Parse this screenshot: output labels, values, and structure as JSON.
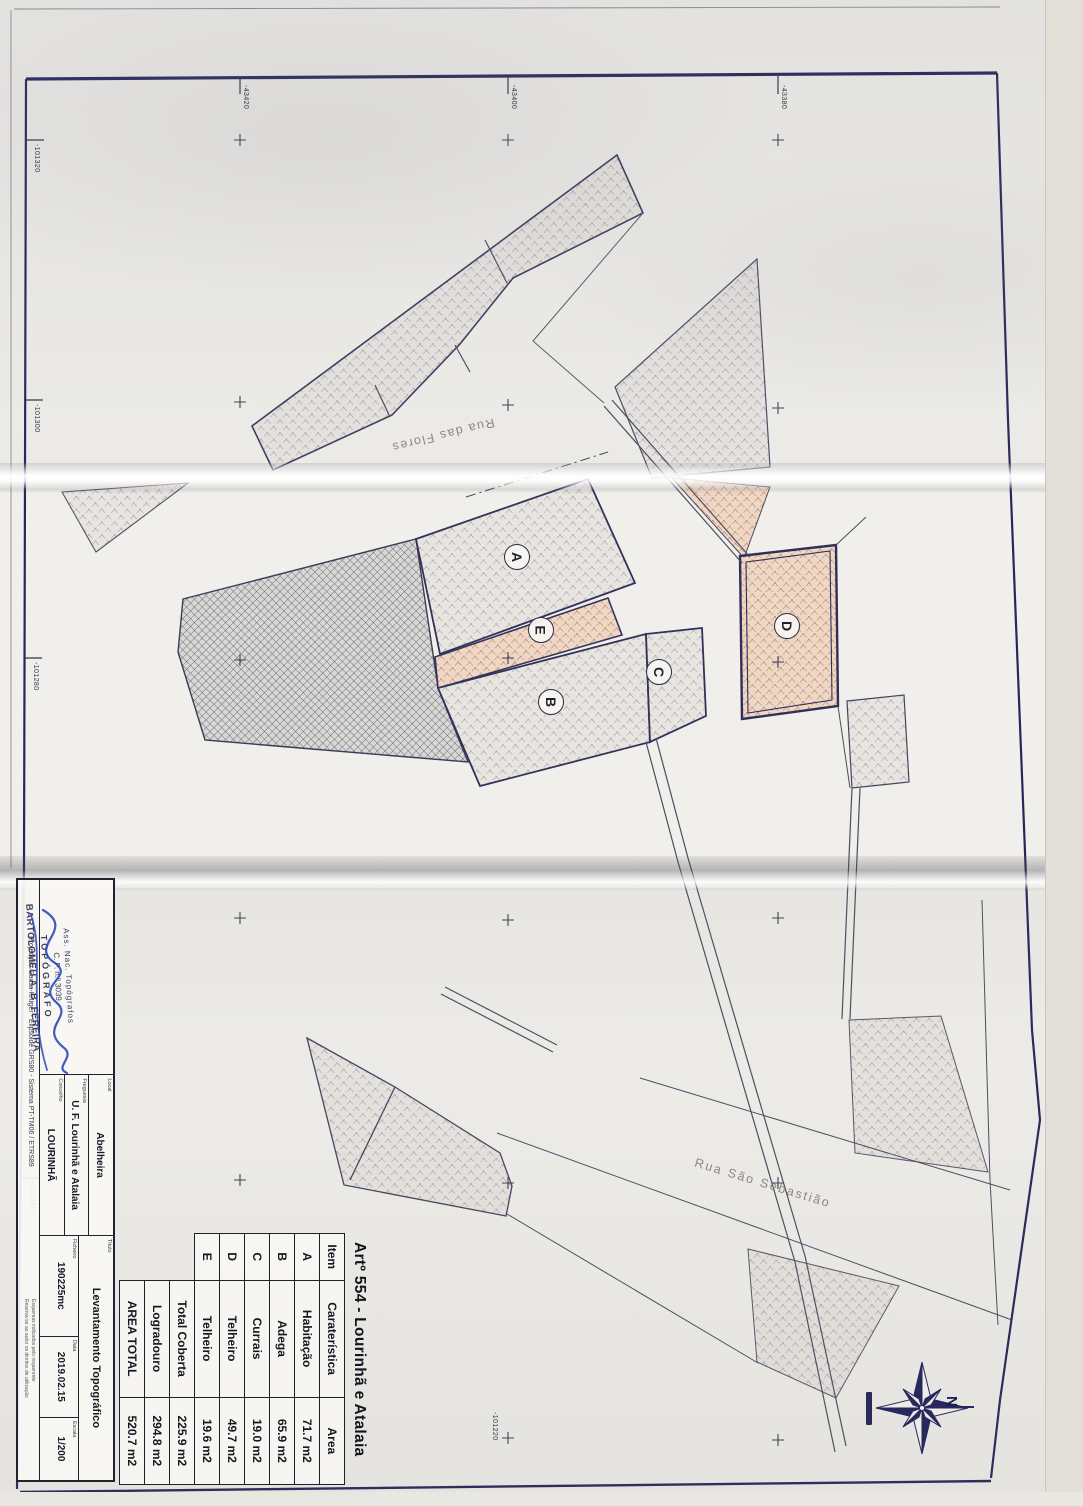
{
  "sheet": {
    "title": "Artº 554 - Lourinhã e Atalaia"
  },
  "areas_table": {
    "headers": {
      "item": "Item",
      "feature": "Caraterística",
      "area": "Area"
    },
    "rows": [
      {
        "item": "A",
        "feature": "Habitação",
        "area": "71.7 m2"
      },
      {
        "item": "B",
        "feature": "Adega",
        "area": "65.9 m2"
      },
      {
        "item": "C",
        "feature": "Currais",
        "area": "19.0 m2"
      },
      {
        "item": "D",
        "feature": "Telheiro",
        "area": "49.7 m2"
      },
      {
        "item": "E",
        "feature": "Telheiro",
        "area": "19.6 m2"
      }
    ],
    "totals": [
      {
        "label": "Total Coberta",
        "area": "225.9 m2"
      },
      {
        "label": "Logradouro",
        "area": "294.8 m2"
      },
      {
        "label": "AREA TOTAL",
        "area": "520.7 m2"
      }
    ]
  },
  "title_block": {
    "stamp": {
      "org": "Ass. Nac. Topógrafos",
      "cp": "C. P. n.º 3039",
      "role": "TOPÓGRAFO",
      "name": "BARTOLOMEU A. B. FEREIRA"
    },
    "projection": "Projecção Gauss-Krüger - Elipsóide GRS80 - Sistema PT-TM06 / ETRS89",
    "fields": [
      {
        "label": "Local",
        "value": "Abelheira"
      },
      {
        "label": "Freguesia",
        "value": "U. F. Lourinhã e Atalaia"
      },
      {
        "label": "Concelho",
        "value": "LOURINHÃ"
      }
    ],
    "titulo": {
      "label": "Título",
      "value": "Levantamento Topográfico"
    },
    "ficheiro": {
      "label": "Ficheiro",
      "value": "190225mc"
    },
    "data": {
      "label": "Data",
      "value": "2019.02.15"
    },
    "escala": {
      "label": "Escala",
      "value": "1/200"
    },
    "notes": [
      "Esquemas indicados pelo requerente",
      "Reserva-se ao autor os direitos de utilização"
    ]
  },
  "plan": {
    "streets": [
      {
        "name": "Rua das Flores"
      },
      {
        "name": "Rua São Sebastião"
      }
    ],
    "parcels": [
      {
        "id": "A"
      },
      {
        "id": "B"
      },
      {
        "id": "C"
      },
      {
        "id": "D"
      },
      {
        "id": "E"
      }
    ],
    "grid": {
      "easting_labels": [
        "-101320",
        "-101300",
        "-101280",
        "-101260",
        "-101240",
        "-101220"
      ],
      "northing_labels": [
        "-43420",
        "-43400",
        "-43380"
      ]
    },
    "compass": {
      "north": "N"
    }
  },
  "colors": {
    "paper": "#efede9",
    "ink": "#30305e",
    "hatch_grey": "#9493a0",
    "hatch_dark": "#6b6a78",
    "hatch_salmon": "#b07a5e",
    "signature_blue": "#2b49b8"
  }
}
